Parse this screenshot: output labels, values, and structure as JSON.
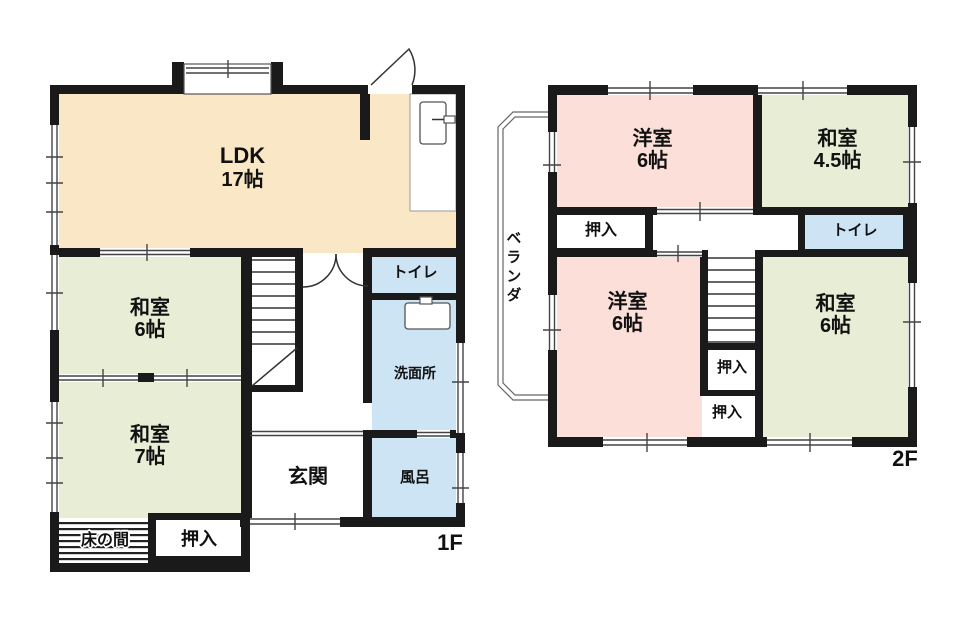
{
  "palette": {
    "wall": "#1a1a1a",
    "ldk_fill": "#FAE7C5",
    "washitsu_fill": "#E8EDD5",
    "youshitsu_fill": "#FBDFD8",
    "water_fill": "#CDE4F4"
  },
  "floor1": {
    "label": "1F",
    "ldk": {
      "name": "LDK",
      "size": "17帖"
    },
    "washitsu6": {
      "name": "和室",
      "size": "6帖"
    },
    "washitsu7": {
      "name": "和室",
      "size": "7帖"
    },
    "tokonoma": {
      "name": "床の間"
    },
    "oshiire": {
      "name": "押入"
    },
    "genkan": {
      "name": "玄関"
    },
    "toilet": {
      "name": "トイレ"
    },
    "senmenjo": {
      "name": "洗面所"
    },
    "furo": {
      "name": "風呂"
    }
  },
  "floor2": {
    "label": "2F",
    "youshitsu_top": {
      "name": "洋室",
      "size": "6帖"
    },
    "washitsu45": {
      "name": "和室",
      "size": "4.5帖"
    },
    "oshiire_top": {
      "name": "押入"
    },
    "toilet": {
      "name": "トイレ"
    },
    "youshitsu_bottom": {
      "name": "洋室",
      "size": "6帖"
    },
    "washitsu6": {
      "name": "和室",
      "size": "6帖"
    },
    "oshiire_mid": {
      "name": "押入"
    },
    "oshiire_lower": {
      "name": "押入"
    },
    "veranda": {
      "name": "ベランダ"
    }
  }
}
